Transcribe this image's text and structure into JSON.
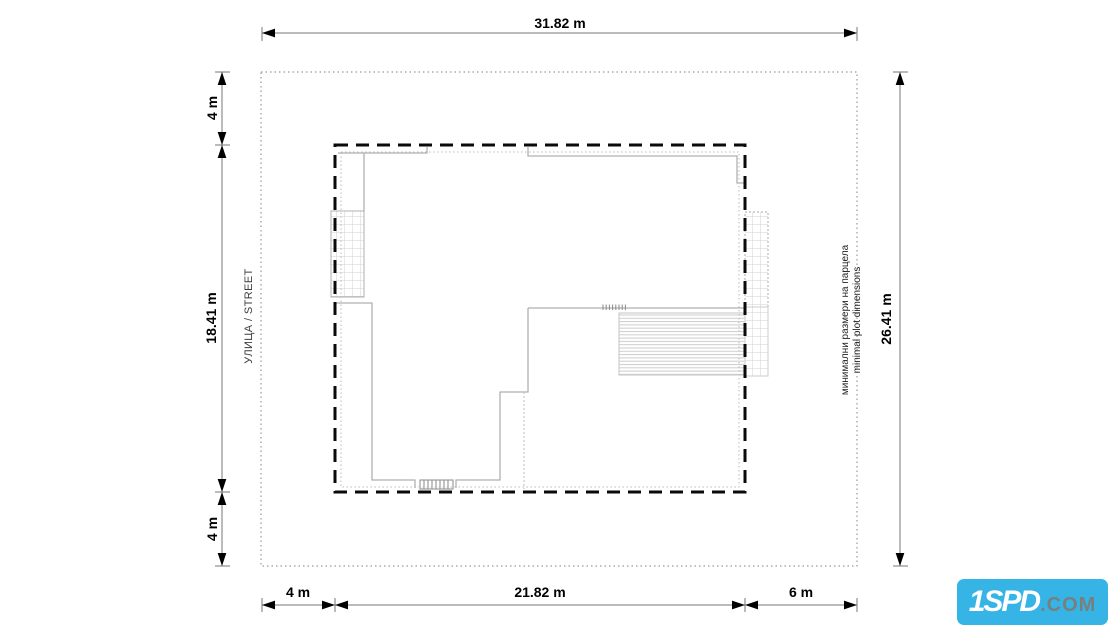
{
  "drawing": {
    "title": "minimal plot dimensions site plan",
    "dimensions": {
      "plot_width": "31.82 m",
      "plot_height": "26.41 m",
      "setback_top": "4 m",
      "building_depth": "18.41 m",
      "setback_bottom": "4 m",
      "setback_left": "4 m",
      "building_width": "21.82 m",
      "setback_right": "6 m"
    },
    "labels": {
      "street": "УЛИЦА / STREET",
      "note_bg": "минимални размери на парцела",
      "note_en": "minimal plot dimensions"
    },
    "colors": {
      "building_envelope": "#0a0a0a",
      "house_outline": "#b0b0b0",
      "plot_boundary": "#999999",
      "dimension_line": "#777777",
      "dimension_text": "#000000",
      "logo_background": "#35b4e5",
      "logo_brand": "#ffffff",
      "logo_suffix": "#77807f"
    }
  },
  "logo": {
    "brand": "1SPD",
    "suffix": ".COM"
  }
}
